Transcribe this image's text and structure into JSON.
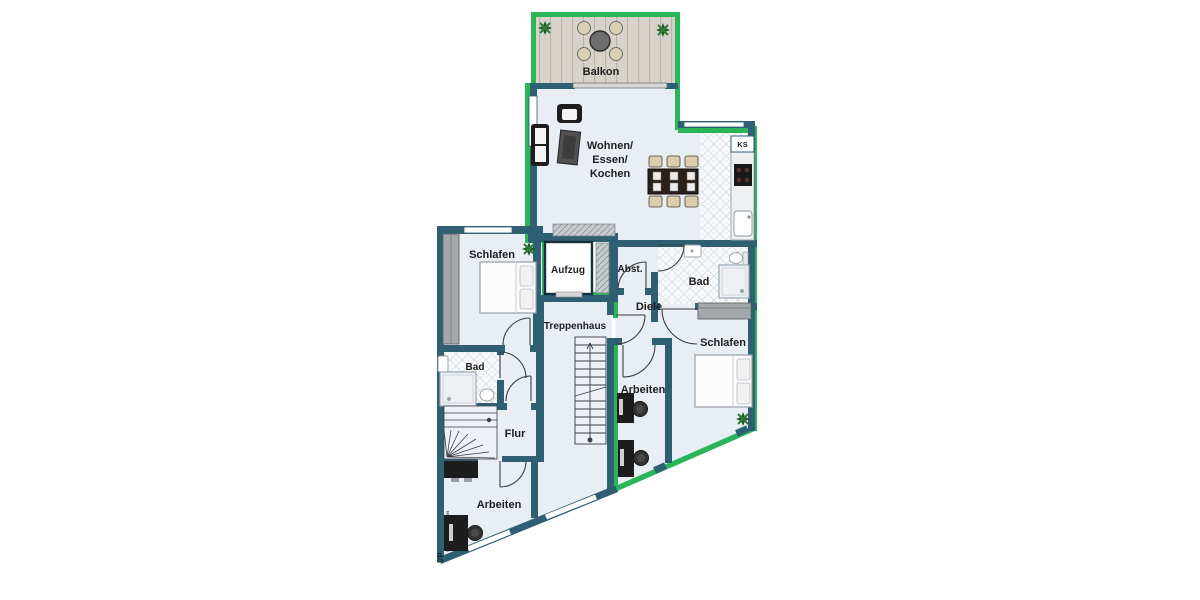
{
  "meta": {
    "title_hint": "apartment floor plan"
  },
  "colors": {
    "wall": "#2f5f73",
    "apartment_outline_green": "#2bb558",
    "floor": "#e9edf4",
    "tile_floor": "#fbfcfd",
    "deck": "#d8d3ca",
    "furniture_dark": "#1d1d1d",
    "chair_beige": "#d9cfae",
    "wardrobe_gray": "#a4a8ab"
  },
  "rooms": {
    "balkon": {
      "label": "Balkon"
    },
    "wohnen": {
      "line1": "Wohnen/",
      "line2": "Essen/",
      "line3": "Kochen"
    },
    "ks": {
      "label": "KS"
    },
    "schlafen_left": {
      "label": "Schlafen"
    },
    "aufzug": {
      "label": "Aufzug"
    },
    "abst": {
      "label": "Abst."
    },
    "bad_top": {
      "label": "Bad"
    },
    "diele": {
      "label": "Diele"
    },
    "treppenhaus": {
      "label": "Treppenhaus"
    },
    "schlafen_right": {
      "label": "Schlafen"
    },
    "bad_left": {
      "label": "Bad"
    },
    "arbeiten_mid": {
      "label": "Arbeiten"
    },
    "flur": {
      "label": "Flur"
    },
    "arbeiten_bl": {
      "label": "Arbeiten"
    }
  },
  "furniture_icons": {
    "balkon": [
      "round-table-icon",
      "patio-chair-icon",
      "plant-icon"
    ],
    "wohnen": [
      "sofa-icon",
      "armchair-icon",
      "tv-icon",
      "dining-table-icon",
      "dining-chair-icon"
    ],
    "kueche": [
      "kitchen-counter-icon",
      "stove-icon",
      "sink-icon",
      "fridge-icon"
    ],
    "schlafen": [
      "double-bed-icon",
      "wardrobe-icon",
      "plant-icon"
    ],
    "bad": [
      "shower-icon",
      "washbasin-icon",
      "toilet-icon"
    ],
    "arbeiten": [
      "desk-icon",
      "office-chair-icon"
    ],
    "treppen": [
      "straight-stair-icon",
      "winder-stair-icon"
    ]
  },
  "watermark": {
    "initials": "VP",
    "text": "VON POLL IMMOBILIEN"
  }
}
